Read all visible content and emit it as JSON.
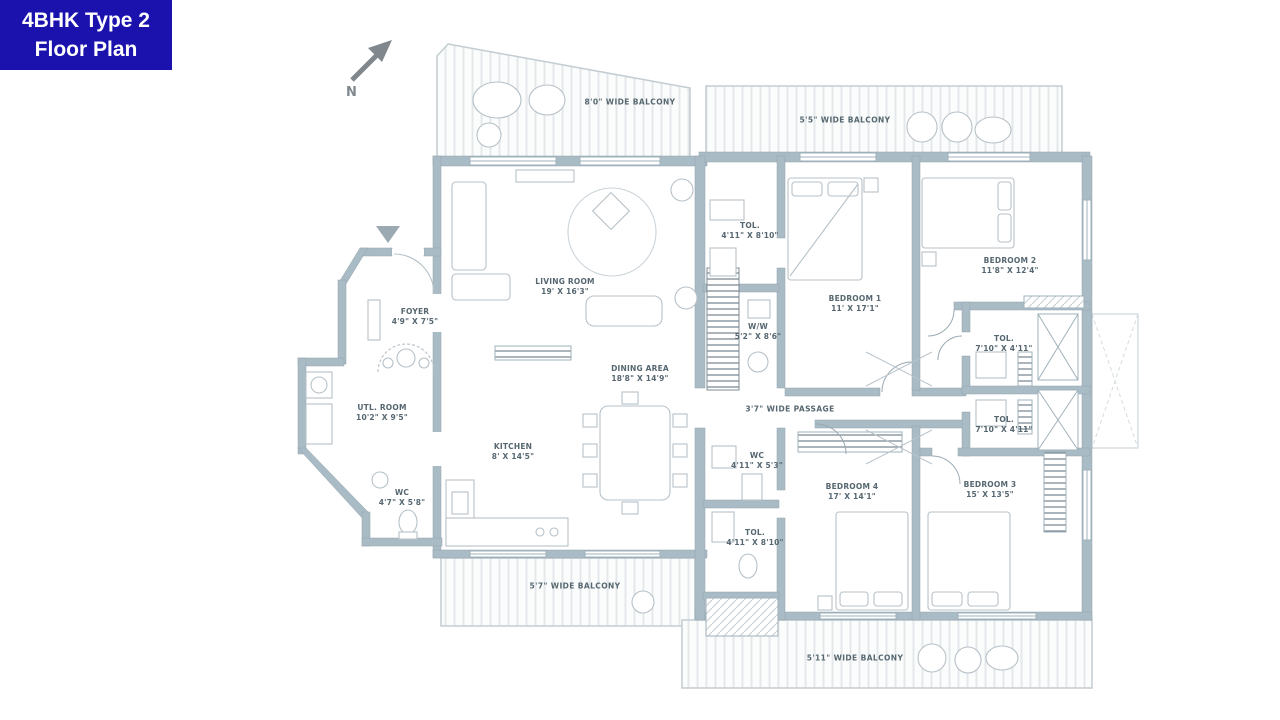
{
  "badge": {
    "line1": "4BHK Type 2",
    "line2": "Floor Plan"
  },
  "compass": {
    "label": "N"
  },
  "colors": {
    "badge_bg": "#1b12ae",
    "wall": "#a9bbc5",
    "balcony_line": "#c3ccd1",
    "label_text": "#566770",
    "furniture_line": "#b6c1c8"
  },
  "rooms": [
    {
      "name": "LIVING ROOM",
      "dims": "19' X 16'3\""
    },
    {
      "name": "DINING AREA",
      "dims": "18'8\" X 14'9\""
    },
    {
      "name": "KITCHEN",
      "dims": "8' X 14'5\""
    },
    {
      "name": "FOYER",
      "dims": "4'9\" X 7'5\""
    },
    {
      "name": "UTL. ROOM",
      "dims": "10'2\" X 9'5\""
    },
    {
      "name": "WC",
      "dims": "4'7\" X 5'8\""
    },
    {
      "name": "TOL.",
      "dims": "4'11\" X 8'10\""
    },
    {
      "name": "W/W",
      "dims": "5'2\" X 8'6\""
    },
    {
      "name": "BEDROOM 1",
      "dims": "11' X 17'1\""
    },
    {
      "name": "BEDROOM 2",
      "dims": "11'8\" X 12'4\""
    },
    {
      "name": "TOL.",
      "dims": "7'10\" X 4'11\""
    },
    {
      "name": "TOL.",
      "dims": "7'10\" X 4'11\""
    },
    {
      "name": "WC",
      "dims": "4'11\" X 5'3\""
    },
    {
      "name": "TOL.",
      "dims": "4'11\" X 8'10\""
    },
    {
      "name": "BEDROOM 4",
      "dims": "17' X 14'1\""
    },
    {
      "name": "BEDROOM 3",
      "dims": "15' X 13'5\""
    }
  ],
  "balconies": [
    {
      "label": "8'0\" WIDE BALCONY"
    },
    {
      "label": "5'5\" WIDE BALCONY"
    },
    {
      "label": "5'7\" WIDE BALCONY"
    },
    {
      "label": "5'11\" WIDE BALCONY"
    }
  ],
  "passage": {
    "label": "3'7\" WIDE PASSAGE"
  }
}
